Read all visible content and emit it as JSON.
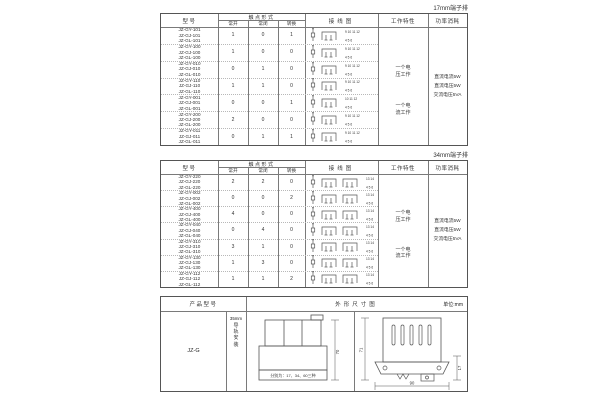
{
  "headers": {
    "model": "型号",
    "contact_form": "触点形式",
    "normally_open": "常开",
    "normally_closed": "常闭",
    "changeover": "转换",
    "wiring_diagram": "接线图",
    "work_feature": "工作特性",
    "power_consumption": "功率消耗"
  },
  "table1": {
    "corner_label": "17mm端子排",
    "rows": [
      {
        "models": [
          "JZ-GY-101",
          "JZ-GJ-101",
          "JZ-GL-101"
        ],
        "no": "1",
        "nc": "0",
        "co": "1",
        "groups": 1,
        "pins_top": "9 10 11 12",
        "pins_bottom": "4 5 6"
      },
      {
        "models": [
          "JZ-GY-100",
          "JZ-GJ-100",
          "JZ-GL-100"
        ],
        "no": "1",
        "nc": "0",
        "co": "0",
        "groups": 1,
        "pins_top": "9 10 11 12",
        "pins_bottom": "4 5 6"
      },
      {
        "models": [
          "JZ-GY-010",
          "JZ-GJ-010",
          "JZ-GL-010"
        ],
        "no": "0",
        "nc": "1",
        "co": "0",
        "groups": 1,
        "pins_top": "9 10 11 12",
        "pins_bottom": "4 5 6"
      },
      {
        "models": [
          "JZ-GY-110",
          "JZ-GJ-110",
          "JZ-GL-110"
        ],
        "no": "1",
        "nc": "1",
        "co": "0",
        "groups": 1,
        "pins_top": "9 10 11 12",
        "pins_bottom": "4 5 6"
      },
      {
        "models": [
          "JZ-GY-001",
          "JZ-GJ-001",
          "JZ-GL-001"
        ],
        "no": "0",
        "nc": "0",
        "co": "1",
        "groups": 1,
        "pins_top": "10 11 12",
        "pins_bottom": "4 5 6"
      },
      {
        "models": [
          "JZ-GY-200",
          "JZ-GJ-200",
          "JZ-GL-200"
        ],
        "no": "2",
        "nc": "0",
        "co": "0",
        "groups": 1,
        "pins_top": "9 10 11 12",
        "pins_bottom": "4 5 6"
      },
      {
        "models": [
          "JZ-GY-011",
          "JZ-GJ-011",
          "JZ-GL-011"
        ],
        "no": "0",
        "nc": "1",
        "co": "1",
        "groups": 1,
        "pins_top": "9 10 11 12",
        "pins_bottom": "4 5 6"
      }
    ],
    "work_modes": [
      "一个电\n压工作",
      "一个电\n流工作"
    ],
    "power_items": "直流电流5W\n直流电压5W\n交流电压5VA"
  },
  "table2": {
    "corner_label": "34mm端子排",
    "rows": [
      {
        "models": [
          "JZ-GY-220",
          "JZ-GJ-220",
          "JZ-GL-220"
        ],
        "no": "2",
        "nc": "2",
        "co": "0",
        "groups": 2,
        "pins_top": "13 14",
        "pins_bottom": "4 5 6"
      },
      {
        "models": [
          "JZ-GY-002",
          "JZ-GJ-002",
          "JZ-GL-002"
        ],
        "no": "0",
        "nc": "0",
        "co": "2",
        "groups": 2,
        "pins_top": "13 14",
        "pins_bottom": "4 5 6"
      },
      {
        "models": [
          "JZ-GY-400",
          "JZ-GJ-400",
          "JZ-GL-400"
        ],
        "no": "4",
        "nc": "0",
        "co": "0",
        "groups": 2,
        "pins_top": "13 14",
        "pins_bottom": "4 5 6"
      },
      {
        "models": [
          "JZ-GY-040",
          "JZ-GJ-040",
          "JZ-GL-040"
        ],
        "no": "0",
        "nc": "4",
        "co": "0",
        "groups": 2,
        "pins_top": "13 14",
        "pins_bottom": "4 5 6"
      },
      {
        "models": [
          "JZ-GY-310",
          "JZ-GJ-310",
          "JZ-GL-310"
        ],
        "no": "3",
        "nc": "1",
        "co": "0",
        "groups": 2,
        "pins_top": "13 14",
        "pins_bottom": "4 5 6"
      },
      {
        "models": [
          "JZ-GY-130",
          "JZ-GJ-130",
          "JZ-GL-130"
        ],
        "no": "1",
        "nc": "3",
        "co": "0",
        "groups": 2,
        "pins_top": "13 14",
        "pins_bottom": "4 5 6"
      },
      {
        "models": [
          "JZ-GY-112",
          "JZ-GJ-112",
          "JZ-GL-112"
        ],
        "no": "1",
        "nc": "1",
        "co": "2",
        "groups": 2,
        "pins_top": "13 14",
        "pins_bottom": "4 5 6"
      }
    ],
    "work_modes": [
      "一个电\n压工作",
      "一个电\n流工作"
    ],
    "power_items": "直流电流5W\n直流电压5W\n交流电压5VA"
  },
  "outline": {
    "header_product": "产品型号",
    "header_drawing": "外形尺寸图",
    "header_unit": "单位:mm",
    "product_model": "JZ-G",
    "mount_width": "35mm",
    "mount_text": "导轨安装",
    "caption": "分别为：17、34、60三种",
    "front_dim_height": "70",
    "side_dim_height": "71",
    "side_dim_width": "90",
    "side_dim_rail": "17"
  }
}
